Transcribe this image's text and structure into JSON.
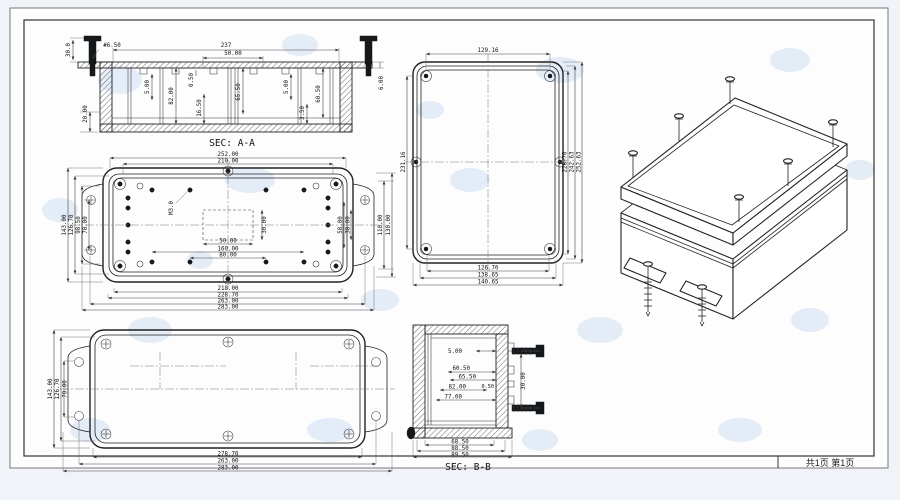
{
  "sheet": {
    "footer": {
      "page_info": "共1页 第1页"
    }
  },
  "sec_aa": {
    "caption": "SEC: A-A",
    "screw_len": "30.0",
    "hole_dia": "#6.50",
    "top_width": "237",
    "slot_width": "50.00",
    "rib_left": "5.00",
    "depth": "82.00",
    "lip": "0.50",
    "boss_h": "16.50",
    "mid_h": "65.50",
    "rib_right": "5.00",
    "right_h": "60.50",
    "wall": "3.50",
    "flange": "6.00",
    "base_h": "20.00"
  },
  "plan_view": {
    "top": [
      "252.00",
      "210.00"
    ],
    "left": [
      "143.00",
      "126.70",
      "98.50",
      "70.00"
    ],
    "right_outer": [
      "110.00",
      "130.00"
    ],
    "right_inner": [
      "58.00",
      "38.00"
    ],
    "center": {
      "width": "50.00",
      "height": "30.00",
      "boss_span": "160.00",
      "boss_span_inner": "80.00",
      "thread_label": "M3.0"
    },
    "bottom": [
      "218.00",
      "228.70",
      "263.00",
      "283.00"
    ]
  },
  "lid_view": {
    "left": [
      "143.00",
      "126.70",
      "70.00"
    ],
    "bottom": [
      "278.70",
      "263.00",
      "283.00"
    ]
  },
  "side_view": {
    "top": "129.16",
    "left": "231.16",
    "right": [
      "228.70",
      "242.63",
      "252.63"
    ],
    "bottom": [
      "126.70",
      "138.65",
      "140.65"
    ]
  },
  "sec_bb": {
    "caption": "SEC: B-B",
    "d_top": "5.00",
    "d1": "60.50",
    "d2": "65.50",
    "d3": "82.00",
    "d_gap": "0.50",
    "d4": "77.00",
    "d_v": "30.00",
    "bottom": [
      "68.50",
      "88.50",
      "89.50"
    ]
  }
}
